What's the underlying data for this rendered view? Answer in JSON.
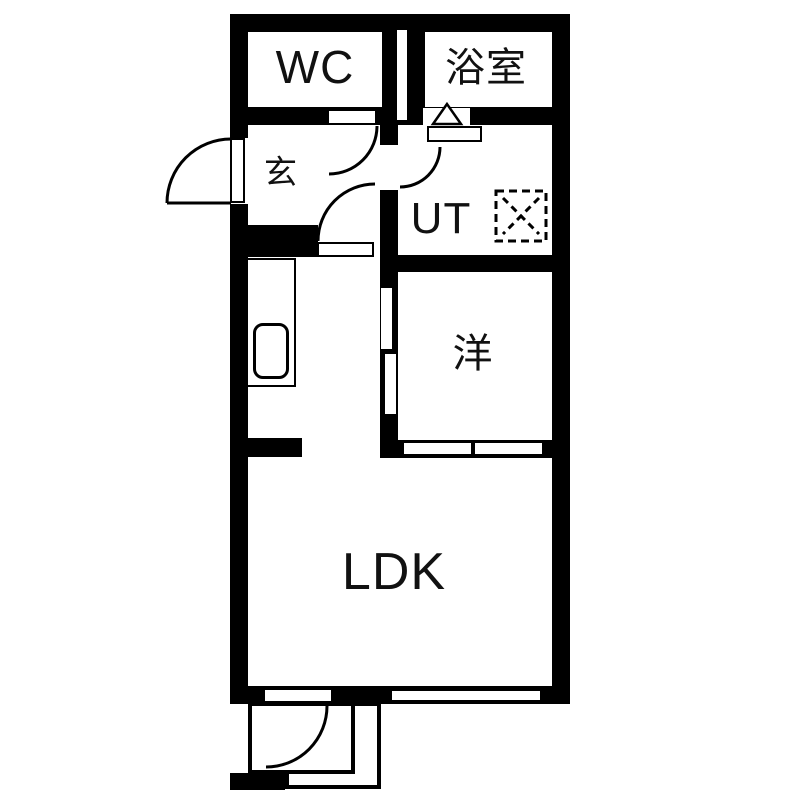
{
  "plan": {
    "type": "apartment-floor-plan",
    "background_color": "#ffffff",
    "wall_color": "#000000",
    "line_color": "#111111",
    "rooms": {
      "wc": {
        "label": "WC"
      },
      "bath": {
        "label": "浴室"
      },
      "entrance": {
        "label": "玄"
      },
      "utility": {
        "label": "UT"
      },
      "western": {
        "label": "洋"
      },
      "ldk": {
        "label": "LDK"
      }
    },
    "symbols": [
      "entry-door-swing-icon",
      "wc-door-swing-icon",
      "hall-door-swing-icon",
      "utility-door-swing-icon",
      "terrace-door-swing-icon",
      "bath-folding-door-icon",
      "washing-machine-area-icon",
      "kitchen-sink-icon",
      "sliding-door-icon",
      "window-icon"
    ]
  }
}
